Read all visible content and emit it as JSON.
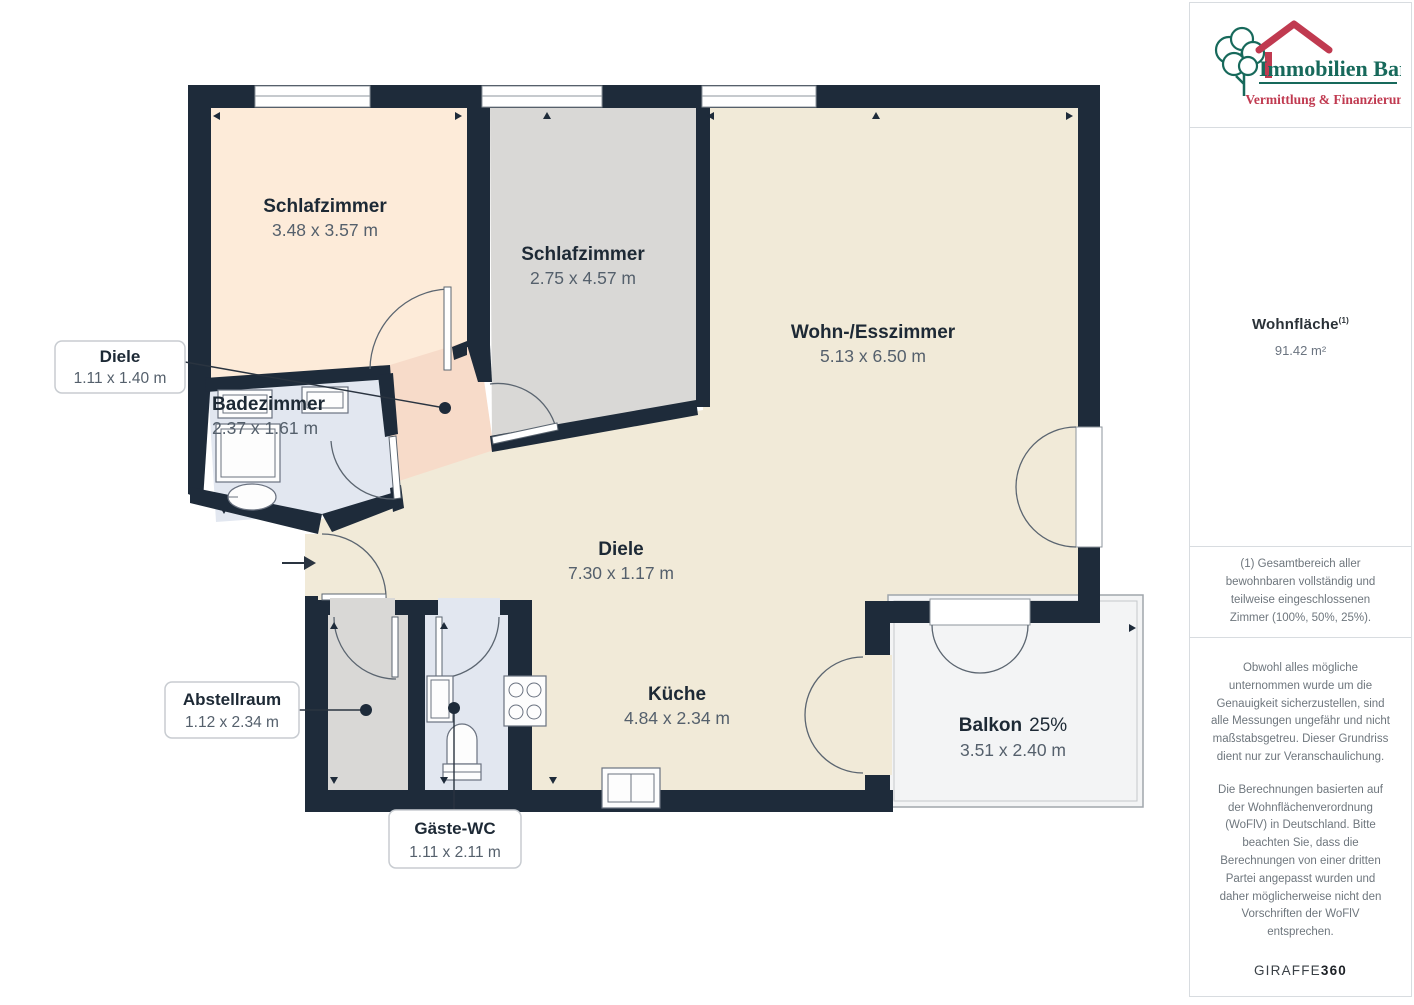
{
  "floorplan": {
    "rooms": [
      {
        "label": "Schlafzimmer",
        "dims": "3.48 x 3.57 m"
      },
      {
        "label": "Schlafzimmer",
        "dims": "2.75 x 4.57 m"
      },
      {
        "label": "Wohn-/Esszimmer",
        "dims": "5.13 x 6.50 m"
      },
      {
        "label": "Diele",
        "dims": "7.30 x 1.17 m"
      },
      {
        "label": "Badezimmer",
        "dims": "2.37 x 1.61 m"
      },
      {
        "label": "Küche",
        "dims": "4.84 x 2.34 m"
      },
      {
        "label": "Balkon",
        "share": "25%",
        "dims": "3.51 x 2.40 m"
      }
    ],
    "callouts": [
      {
        "label": "Diele",
        "dims": "1.11 x 1.40 m"
      },
      {
        "label": "Abstellraum",
        "dims": "1.12 x 2.34 m"
      },
      {
        "label": "Gäste-WC",
        "dims": "1.11 x 2.11 m"
      }
    ]
  },
  "sidebar": {
    "logo": {
      "name": "Immobilien Bart",
      "tagline": "Vermittlung & Finanzierung"
    },
    "area": {
      "label": "Wohnfläche",
      "marker": "(1)",
      "value": "91.42 m²"
    },
    "footnote": "(1) Gesamtbereich aller bewohnbaren vollständig und teilweise eingeschlossenen Zimmer (100%, 50%, 25%).",
    "disclaimer_1": "Obwohl alles mögliche unternommen wurde um die Genauigkeit sicherzustellen, sind alle Messungen ungefähr und nicht maßstabsgetreu. Dieser Grundriss dient nur zur Veranschaulichung.",
    "disclaimer_2": "Die Berechnungen basierten auf der Wohnflächenverordnung (WoFlV) in Deutschland. Bitte beachten Sie, dass die Berechnungen von einer dritten Partei angepasst wurden und daher möglicherweise nicht den Vorschriften der WoFlV entsprechen.",
    "brand": {
      "name": "GIRAFFE",
      "suffix": "360"
    }
  },
  "colors": {
    "wall": "#1e2b3a",
    "cream": "#f1ead8",
    "peach": "#fdebd9",
    "gray_room": "#d9d8d6",
    "blue_room": "#e2e7f0",
    "salmon": "#f7dbc9",
    "balcony": "#f3f4f5",
    "logo_green": "#17695b",
    "logo_red": "#c03a50"
  }
}
